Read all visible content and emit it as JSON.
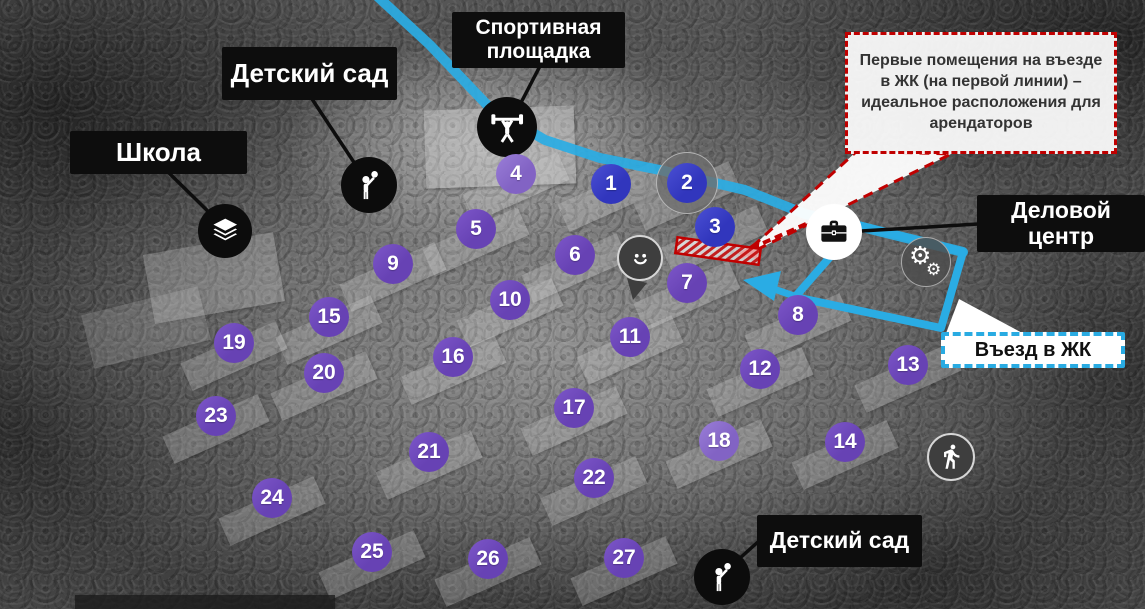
{
  "map": {
    "title_labels": [
      {
        "id": "school",
        "text": "Школа",
        "x": 70,
        "y": 131,
        "w": 177,
        "h": 43,
        "type": "black",
        "fs": 26
      },
      {
        "id": "kindergarten-top",
        "text": "Детский сад",
        "x": 222,
        "y": 47,
        "w": 175,
        "h": 53,
        "type": "black",
        "fs": 26
      },
      {
        "id": "sports-ground",
        "text": "Спортивная площадка",
        "x": 452,
        "y": 12,
        "w": 173,
        "h": 56,
        "type": "black",
        "fs": 21
      },
      {
        "id": "business-center",
        "text": "Деловой центр",
        "x": 977,
        "y": 195,
        "w": 168,
        "h": 57,
        "type": "black",
        "fs": 23
      },
      {
        "id": "kindergarten-bottom",
        "text": "Детский сад",
        "x": 757,
        "y": 515,
        "w": 165,
        "h": 52,
        "type": "black",
        "fs": 23
      },
      {
        "id": "entrance",
        "text": "Въезд в ЖК",
        "x": 941,
        "y": 332,
        "w": 184,
        "h": 36,
        "type": "cyan",
        "fs": 20
      }
    ],
    "callout": {
      "text": "Первые помещения на въезде в ЖК (на первой линии) – идеальное расположения для арендаторов",
      "x": 845,
      "y": 32,
      "w": 272,
      "h": 122
    },
    "markers": [
      {
        "n": "1",
        "x": 611,
        "y": 184,
        "c": "blue"
      },
      {
        "n": "2",
        "x": 687,
        "y": 183,
        "c": "blue",
        "halo": true
      },
      {
        "n": "3",
        "x": 715,
        "y": 227,
        "c": "blue"
      },
      {
        "n": "4",
        "x": 516,
        "y": 174,
        "c": "light"
      },
      {
        "n": "5",
        "x": 476,
        "y": 229,
        "c": "purple"
      },
      {
        "n": "6",
        "x": 575,
        "y": 255,
        "c": "purple"
      },
      {
        "n": "7",
        "x": 687,
        "y": 283,
        "c": "purple"
      },
      {
        "n": "8",
        "x": 798,
        "y": 315,
        "c": "purple"
      },
      {
        "n": "9",
        "x": 393,
        "y": 264,
        "c": "purple"
      },
      {
        "n": "10",
        "x": 510,
        "y": 300,
        "c": "purple"
      },
      {
        "n": "11",
        "x": 630,
        "y": 337,
        "c": "purple"
      },
      {
        "n": "12",
        "x": 760,
        "y": 369,
        "c": "purple"
      },
      {
        "n": "13",
        "x": 908,
        "y": 365,
        "c": "purple"
      },
      {
        "n": "14",
        "x": 845,
        "y": 442,
        "c": "purple"
      },
      {
        "n": "15",
        "x": 329,
        "y": 317,
        "c": "purple"
      },
      {
        "n": "16",
        "x": 453,
        "y": 357,
        "c": "purple"
      },
      {
        "n": "17",
        "x": 574,
        "y": 408,
        "c": "purple"
      },
      {
        "n": "18",
        "x": 719,
        "y": 441,
        "c": "light"
      },
      {
        "n": "19",
        "x": 234,
        "y": 343,
        "c": "purple"
      },
      {
        "n": "20",
        "x": 324,
        "y": 373,
        "c": "purple"
      },
      {
        "n": "21",
        "x": 429,
        "y": 452,
        "c": "purple"
      },
      {
        "n": "22",
        "x": 594,
        "y": 478,
        "c": "purple"
      },
      {
        "n": "23",
        "x": 216,
        "y": 416,
        "c": "purple"
      },
      {
        "n": "24",
        "x": 272,
        "y": 498,
        "c": "purple"
      },
      {
        "n": "25",
        "x": 372,
        "y": 552,
        "c": "purple"
      },
      {
        "n": "26",
        "x": 488,
        "y": 559,
        "c": "purple"
      },
      {
        "n": "27",
        "x": 624,
        "y": 558,
        "c": "purple"
      }
    ],
    "pois": [
      {
        "id": "school-icon",
        "glyph": "books-stack",
        "x": 225,
        "y": 231,
        "r": 27,
        "style": "black"
      },
      {
        "id": "kindergarten-top-icon",
        "glyph": "child-with-balloon",
        "x": 369,
        "y": 185,
        "r": 28,
        "style": "black"
      },
      {
        "id": "sports-icon",
        "glyph": "weightlifter",
        "x": 507,
        "y": 127,
        "r": 30,
        "style": "black"
      },
      {
        "id": "smiley-icon",
        "glyph": "smiley-face",
        "x": 640,
        "y": 258,
        "r": 23,
        "style": "gray"
      },
      {
        "id": "briefcase-icon",
        "glyph": "briefcase",
        "x": 834,
        "y": 232,
        "r": 28,
        "style": "white"
      },
      {
        "id": "gears-icon",
        "glyph": "gears",
        "x": 926,
        "y": 262,
        "r": 25,
        "style": "grayt"
      },
      {
        "id": "walk-icon",
        "glyph": "walking-person",
        "x": 951,
        "y": 457,
        "r": 24,
        "style": "gray"
      },
      {
        "id": "kindergarten-bottom-icon",
        "glyph": "child-with-balloon",
        "x": 722,
        "y": 577,
        "r": 28,
        "style": "black"
      }
    ],
    "colors": {
      "marker_purple": "#6e4cbd",
      "marker_blue": "#3a40c4",
      "road_cyan": "#2aace4",
      "accent_red": "#c00000",
      "label_black": "#0d0d0d"
    }
  }
}
